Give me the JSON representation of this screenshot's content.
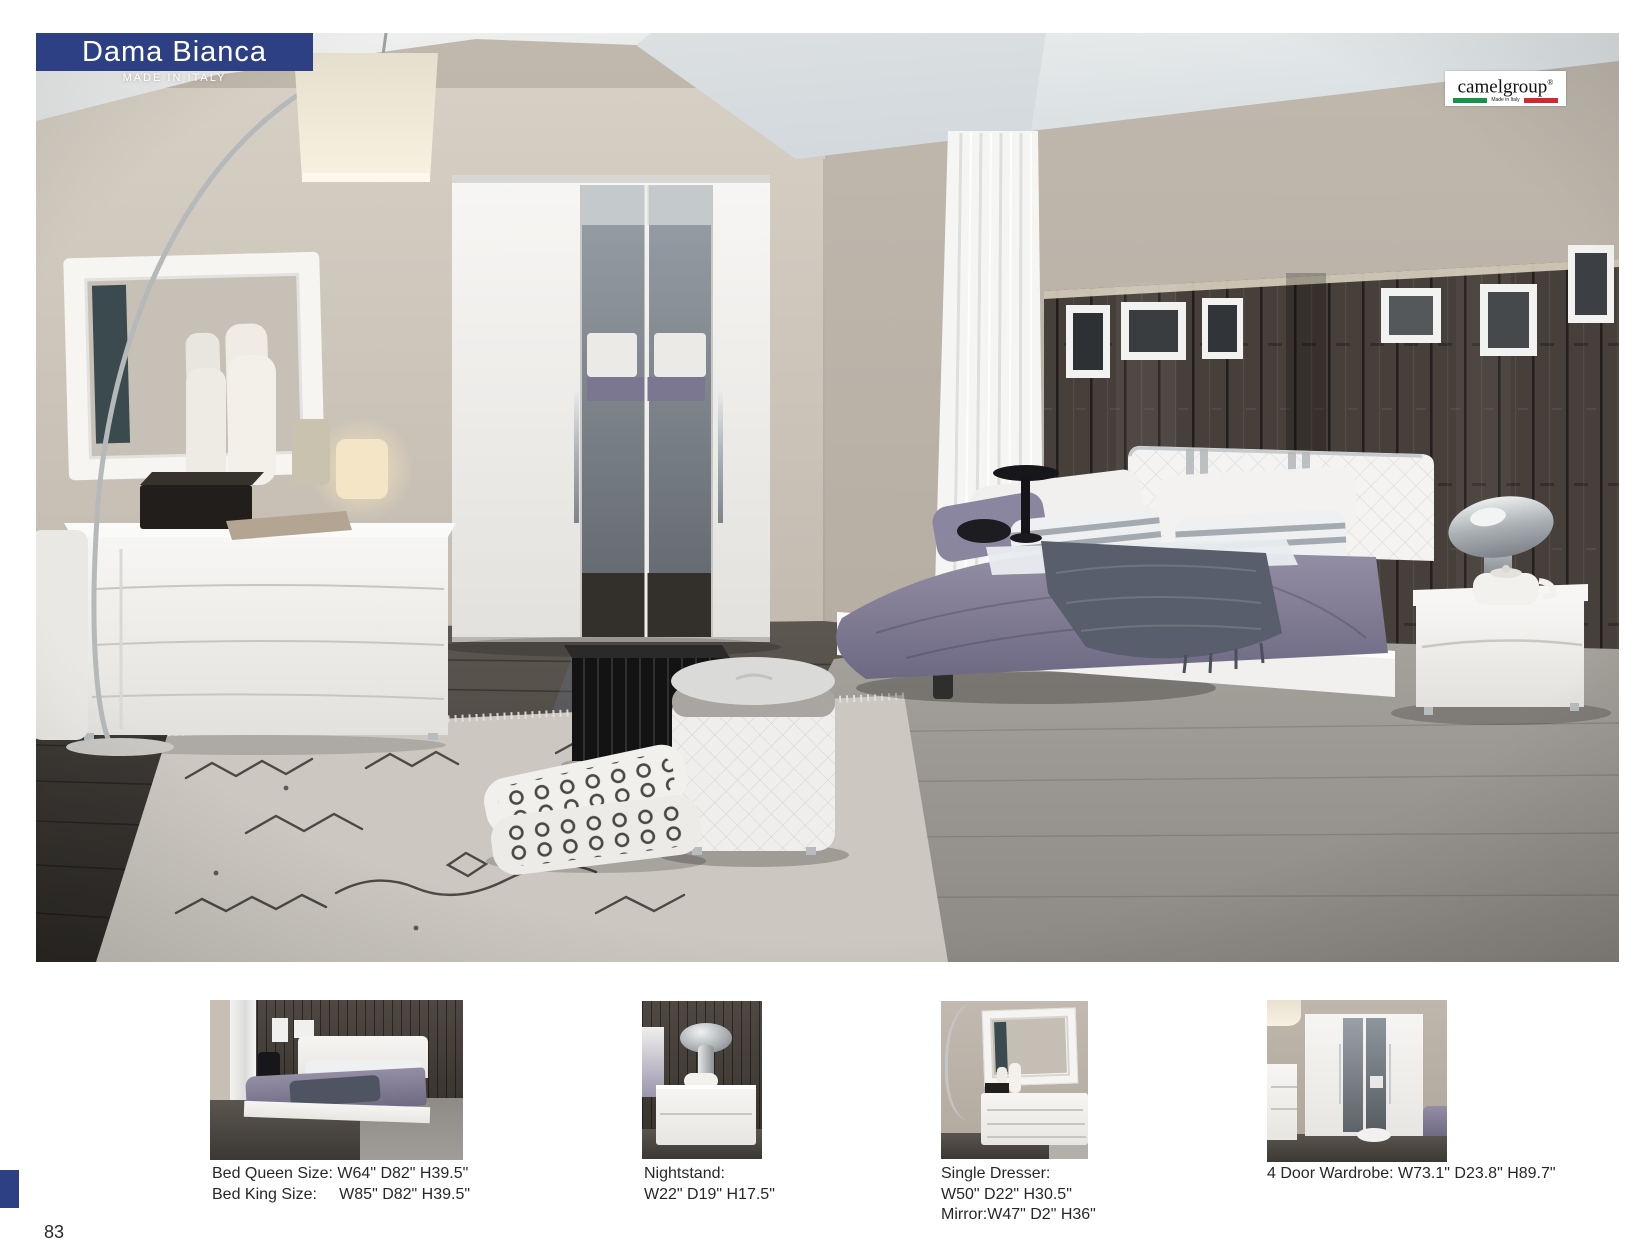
{
  "banner": {
    "title": "Dama Bianca",
    "subtitle": "MADE IN ITALY",
    "accent_color": "#2d4084"
  },
  "brand": {
    "name": "camelgroup",
    "reg": "®",
    "tagline": "Made in Italy",
    "flag_green": "#159447",
    "flag_red": "#d02a2f"
  },
  "footer": {
    "page_number": "83"
  },
  "products": [
    {
      "name": "bed",
      "caption_lines": [
        "Bed Queen Size: W64\" D82\" H39.5\"",
        "Bed King Size:     W85\" D82\" H39.5\""
      ]
    },
    {
      "name": "nightstand",
      "caption_lines": [
        "Nightstand:",
        "W22\" D19\" H17.5\""
      ]
    },
    {
      "name": "single-dresser",
      "caption_lines": [
        "Single Dresser:",
        "W50\" D22\" H30.5\"",
        "Mirror:W47\" D2\" H36\""
      ]
    },
    {
      "name": "wardrobe",
      "caption_lines": [
        "4 Door Wardrobe: W73.1\" D23.8\" H89.7\""
      ]
    }
  ]
}
